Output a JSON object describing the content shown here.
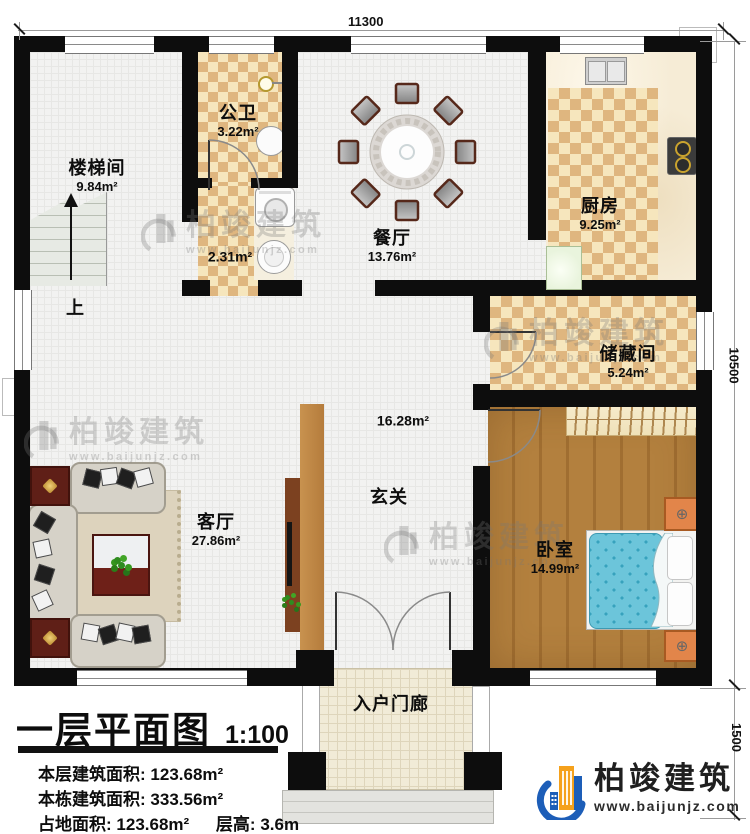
{
  "plan": {
    "dim_top": "11300",
    "dim_right_main": "10500",
    "dim_right_porch": "1500"
  },
  "rooms": {
    "stairwell": {
      "name": "楼梯间",
      "area": "9.84m²"
    },
    "bath": {
      "name": "公卫",
      "area": "3.22m²"
    },
    "laundry": {
      "area": "2.31m²"
    },
    "dining": {
      "name": "餐厅",
      "area": "13.76m²"
    },
    "kitchen": {
      "name": "厨房",
      "area": "9.25m²"
    },
    "storage": {
      "name": "储藏间",
      "area": "5.24m²"
    },
    "hall": {
      "name": "玄关",
      "area": "16.28m²"
    },
    "living": {
      "name": "客厅",
      "area": "27.86m²"
    },
    "bedroom": {
      "name": "卧室",
      "area": "14.99m²"
    },
    "porch": {
      "name": "入户门廊"
    }
  },
  "stairs": {
    "up_label": "上"
  },
  "title_block": {
    "title": "一层平面图",
    "scale": "1:100",
    "floor_area_label": "本层建筑面积:",
    "floor_area_value": "123.68m²",
    "total_area_label": "本栋建筑面积:",
    "total_area_value": "333.56m²",
    "footprint_label": "占地面积:",
    "footprint_value": "123.68m²",
    "height_label": "层高:",
    "height_value": "3.6m"
  },
  "brand": {
    "name": "柏竣建筑",
    "url": "www.baijunjz.com"
  },
  "colors": {
    "wall": "#0d0d0d",
    "checker_dark": "#dfb67f",
    "checker_light": "#f6e6bd",
    "wood_floor": "#b3803e",
    "bed_blue": "#6cc5da",
    "tv_wall": "#c8924f",
    "brand_blue": "#1d5eb8",
    "brand_orange": "#f5a11c"
  }
}
